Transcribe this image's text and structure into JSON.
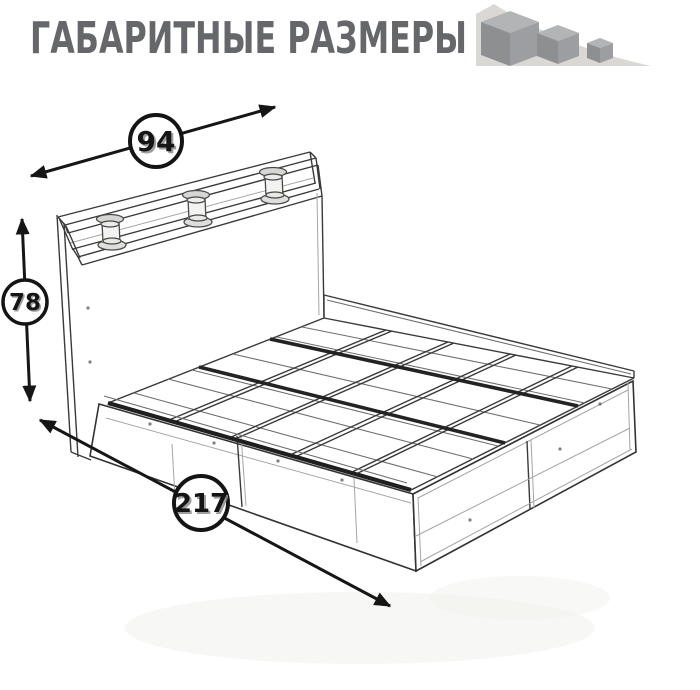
{
  "header": {
    "title": "ГАБАРИТНЫЕ РАЗМЕРЫ",
    "title_color": "#66676b",
    "logo_icon": "three-descending-cubes"
  },
  "diagram": {
    "subject": "bed frame wireframe drawing with headboard shelf, posts and drawers",
    "dimensions": {
      "width": {
        "value": "94"
      },
      "height": {
        "value": "78"
      },
      "length": {
        "value": "217"
      }
    },
    "colors": {
      "line": "#3a3a3a",
      "accent_dark": "#141414",
      "icon_triangle": "#d9d8d4",
      "cube_top": "#b3b4b6",
      "cube_front": "#9d9ea1",
      "cube_side": "#8e8f91"
    }
  }
}
